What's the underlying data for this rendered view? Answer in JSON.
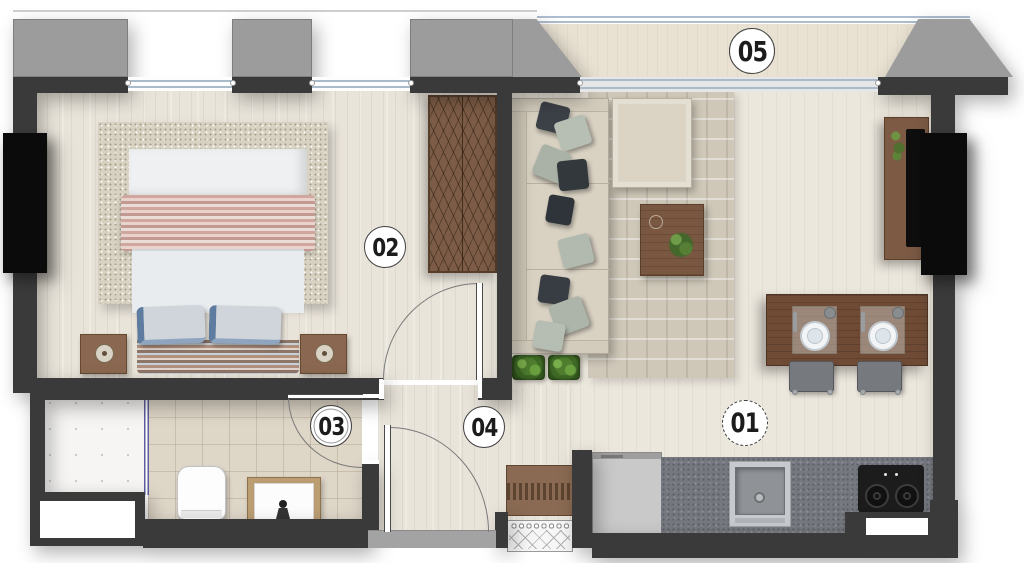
{
  "floorplan": {
    "type": "apartment-floor-plan",
    "labels": [
      {
        "id": "room-01",
        "text": "01"
      },
      {
        "id": "room-02",
        "text": "02"
      },
      {
        "id": "room-03",
        "text": "03"
      },
      {
        "id": "room-04",
        "text": "04"
      },
      {
        "id": "room-05",
        "text": "05"
      }
    ],
    "colors": {
      "wall": "#3a3a3a",
      "column": "#0b0b0b",
      "gray_mass": "#9c9c9c",
      "window_glass": "#a9bacb",
      "wood_floor": "#e9e4da",
      "tile_floor": "#ded6c7",
      "balcony_floor": "#e9e2d3",
      "glass_partition": "#5c5c9e",
      "counter": "#75787e",
      "furniture_wood": "#7c5c46"
    },
    "elements": [
      "bed",
      "bedroom-rug",
      "nightstands",
      "wardrobe",
      "sofa",
      "ottoman",
      "living-rug",
      "coffee-table",
      "floor-plants",
      "tv-console",
      "dining-table",
      "plates",
      "chairs",
      "kitchen-counter",
      "sink",
      "stove",
      "fridge",
      "bench",
      "doormat",
      "toilet",
      "vanity-sink",
      "shaft",
      "balcony-rail"
    ]
  }
}
